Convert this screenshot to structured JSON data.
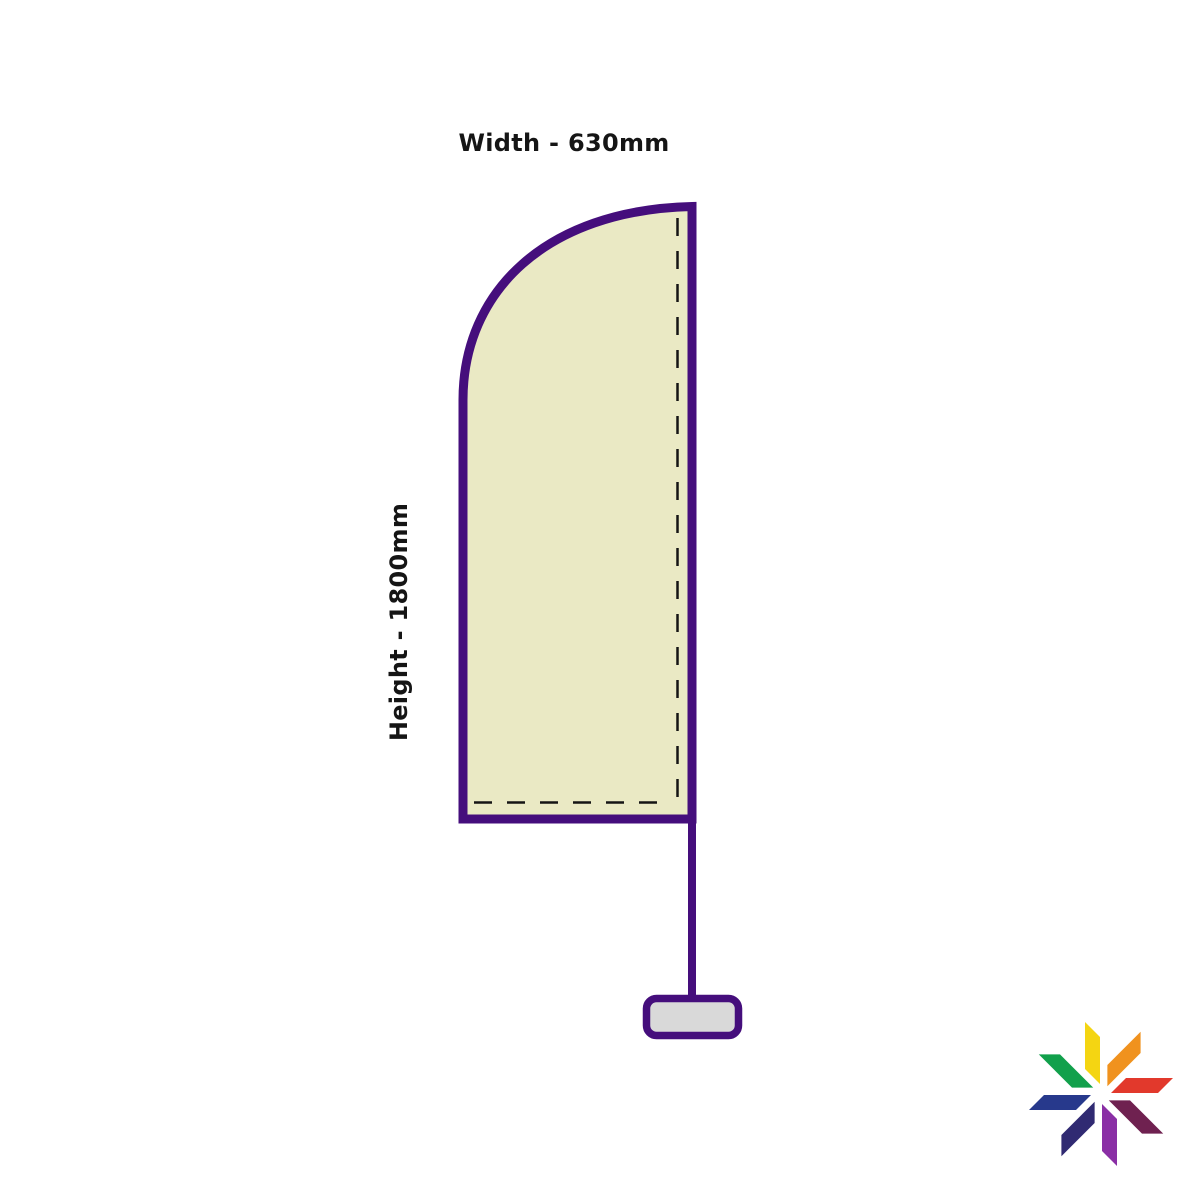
{
  "page": {
    "background_color": "#ffffff"
  },
  "diagram": {
    "width_label": "Width - 630mm",
    "height_label": "Height - 1800mm",
    "flag": {
      "shape": "feather-flag-curved-top",
      "fill": "#EAE9C4",
      "stroke": "#450E7C",
      "stitch_color": "#141414"
    },
    "pole": {
      "color": "#450E7C"
    },
    "base": {
      "fill": "#D9D9D9",
      "stroke": "#450E7C"
    }
  },
  "logo": {
    "name": "eight-petal-pinwheel-logo",
    "petals": [
      {
        "position": "top",
        "color": "#F4D512"
      },
      {
        "position": "top-right",
        "color": "#F0921E"
      },
      {
        "position": "right",
        "color": "#E2392C"
      },
      {
        "position": "bottom-right",
        "color": "#6F2150"
      },
      {
        "position": "bottom",
        "color": "#8A2FA5"
      },
      {
        "position": "bottom-left",
        "color": "#302A72"
      },
      {
        "position": "left",
        "color": "#27398C"
      },
      {
        "position": "top-left",
        "color": "#11A04B"
      }
    ]
  }
}
